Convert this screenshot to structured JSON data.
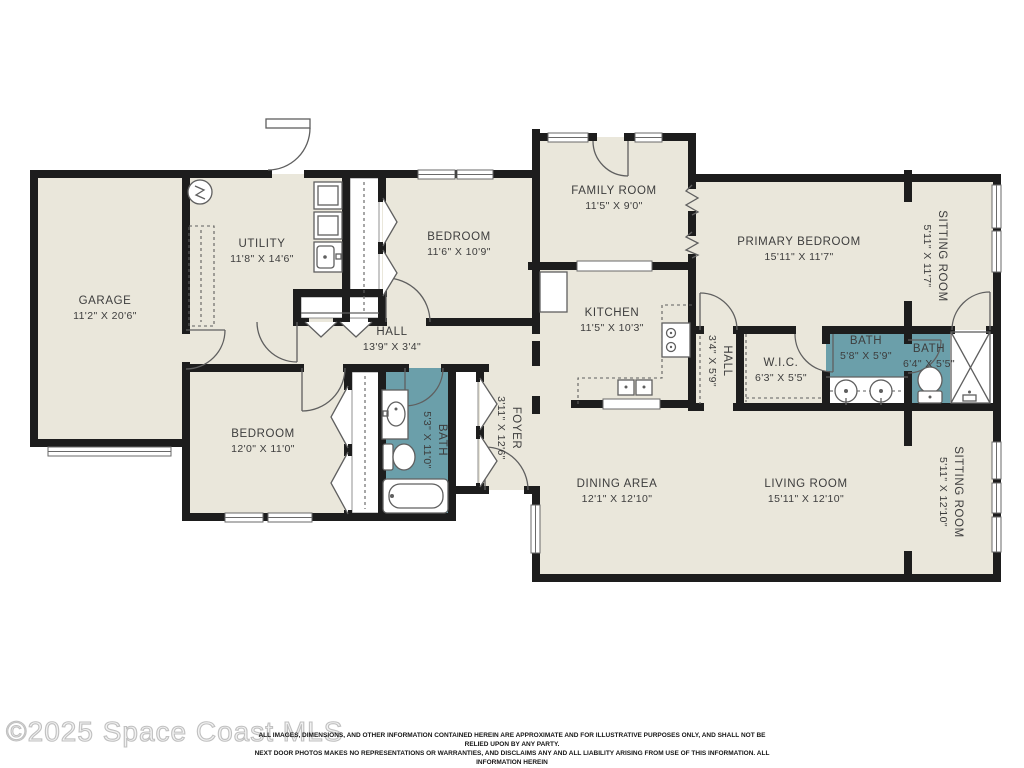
{
  "watermark": {
    "text": "©2025 Space Coast MLS"
  },
  "disclaimer": {
    "line1": "ALL IMAGES, DIMENSIONS, AND OTHER INFORMATION CONTAINED HEREIN ARE APPROXIMATE AND FOR ILLUSTRATIVE PURPOSES ONLY, AND SHALL NOT BE RELIED UPON BY ANY PARTY.",
    "line2": "NEXT DOOR PHOTOS MAKES NO REPRESENTATIONS OR WARRANTIES, AND DISCLAIMS ANY AND ALL LIABILITY ARISING FROM USE OF THIS INFORMATION. ALL INFORMATION HEREIN",
    "line3": "SHALL BE SUBJECT TO THE TERMS AND CONDITIONS FOUND AT NEXTDOORPHOTOS.COM/TC."
  },
  "floorplan": {
    "colors": {
      "room": "#eae7db",
      "bath": "#6b9faa",
      "wall": "#1d1d1d",
      "line": "#5f5f5f",
      "label": "#3d3d3d"
    },
    "rooms": [
      {
        "id": "garage",
        "name": "GARAGE",
        "dims": "11'2\" X 20'6\"",
        "x": 105,
        "y": 307,
        "rot": 0
      },
      {
        "id": "utility",
        "name": "UTILITY",
        "dims": "11'8\" X 14'6\"",
        "x": 262,
        "y": 250,
        "rot": 0
      },
      {
        "id": "bedroom-2",
        "name": "BEDROOM",
        "dims": "11'6\" X 10'9\"",
        "x": 459,
        "y": 243,
        "rot": 0
      },
      {
        "id": "family-room",
        "name": "FAMILY ROOM",
        "dims": "11'5\" X 9'0\"",
        "x": 614,
        "y": 197,
        "rot": 0
      },
      {
        "id": "primary-bedroom",
        "name": "PRIMARY BEDROOM",
        "dims": "15'11\" X 11'7\"",
        "x": 799,
        "y": 248,
        "rot": 0
      },
      {
        "id": "sitting-room-1",
        "name": "SITTING ROOM",
        "dims": "5'11\" X 11'7\"",
        "x": 936,
        "y": 256,
        "rot": 90
      },
      {
        "id": "hall",
        "name": "HALL",
        "dims": "13'9\" X 3'4\"",
        "x": 392,
        "y": 338,
        "rot": 0
      },
      {
        "id": "kitchen",
        "name": "KITCHEN",
        "dims": "11'5\" X 10'3\"",
        "x": 612,
        "y": 319,
        "rot": 0
      },
      {
        "id": "hall-2",
        "name": "HALL",
        "dims": "3'4\" X 5'9\"",
        "x": 721,
        "y": 361,
        "rot": 90
      },
      {
        "id": "wic",
        "name": "W.I.C.",
        "dims": "6'3\" X 5'5\"",
        "x": 781,
        "y": 369,
        "rot": 0
      },
      {
        "id": "bath-primary",
        "name": "BATH",
        "dims": "5'8\" X 5'9\"",
        "x": 866,
        "y": 347,
        "rot": 0
      },
      {
        "id": "bath-2",
        "name": "BATH",
        "dims": "6'4\" X 5'5\"",
        "x": 929,
        "y": 355,
        "rot": 0
      },
      {
        "id": "bedroom-3",
        "name": "BEDROOM",
        "dims": "12'0\" X 11'0\"",
        "x": 263,
        "y": 440,
        "rot": 0
      },
      {
        "id": "bath-hall",
        "name": "BATH",
        "dims": "5'3\" X 11'0\"",
        "x": 436,
        "y": 440,
        "rot": 90
      },
      {
        "id": "foyer",
        "name": "FOYER",
        "dims": "3'11\" X 12'6\"",
        "x": 510,
        "y": 428,
        "rot": 90
      },
      {
        "id": "dining-area",
        "name": "DINING AREA",
        "dims": "12'1\" X 12'10\"",
        "x": 617,
        "y": 490,
        "rot": 0
      },
      {
        "id": "living-room",
        "name": "LIVING ROOM",
        "dims": "15'11\" X 12'10\"",
        "x": 806,
        "y": 490,
        "rot": 0
      },
      {
        "id": "sitting-room-2",
        "name": "SITTING ROOM",
        "dims": "5'11\" X 12'10\"",
        "x": 952,
        "y": 492,
        "rot": 90
      }
    ]
  }
}
